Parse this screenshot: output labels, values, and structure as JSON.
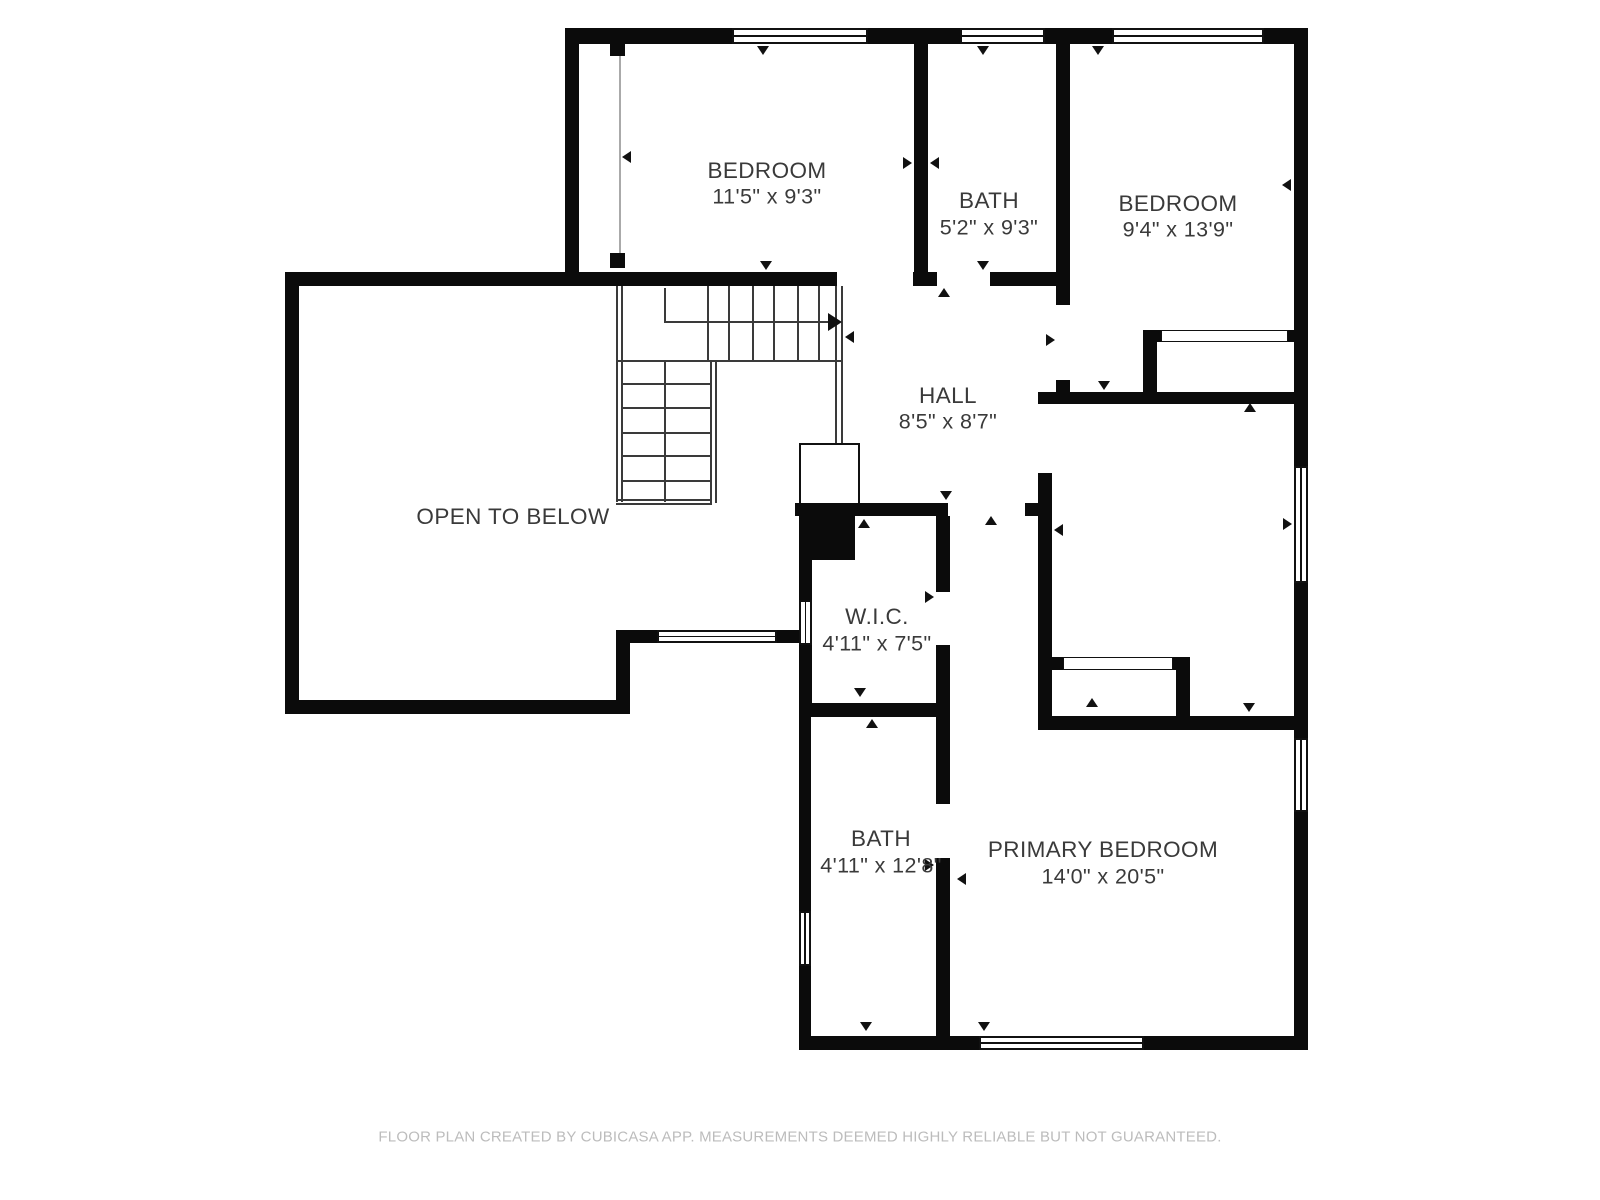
{
  "colors": {
    "wall": "#0b0b0b",
    "text": "#3a3a3a",
    "muted": "#bcbcbc",
    "background": "#ffffff"
  },
  "rooms": {
    "bedroom_top_left": {
      "name": "BEDROOM",
      "dims": "11'5\" x 9'3\""
    },
    "bath_top": {
      "name": "BATH",
      "dims": "5'2\" x 9'3\""
    },
    "bedroom_top_right": {
      "name": "BEDROOM",
      "dims": "9'4\" x 13'9\""
    },
    "hall": {
      "name": "HALL",
      "dims": "8'5\" x 8'7\""
    },
    "open_to_below": {
      "name": "OPEN TO BELOW"
    },
    "wic": {
      "name": "W.I.C.",
      "dims": "4'11\" x 7'5\""
    },
    "bath_main": {
      "name": "BATH",
      "dims": "4'11\" x 12'8\""
    },
    "primary_bedroom": {
      "name": "PRIMARY BEDROOM",
      "dims": "14'0\" x 20'5\""
    }
  },
  "footer": {
    "text": "FLOOR PLAN CREATED BY CUBICASA APP. MEASUREMENTS DEEMED HIGHLY RELIABLE BUT NOT GUARANTEED."
  }
}
